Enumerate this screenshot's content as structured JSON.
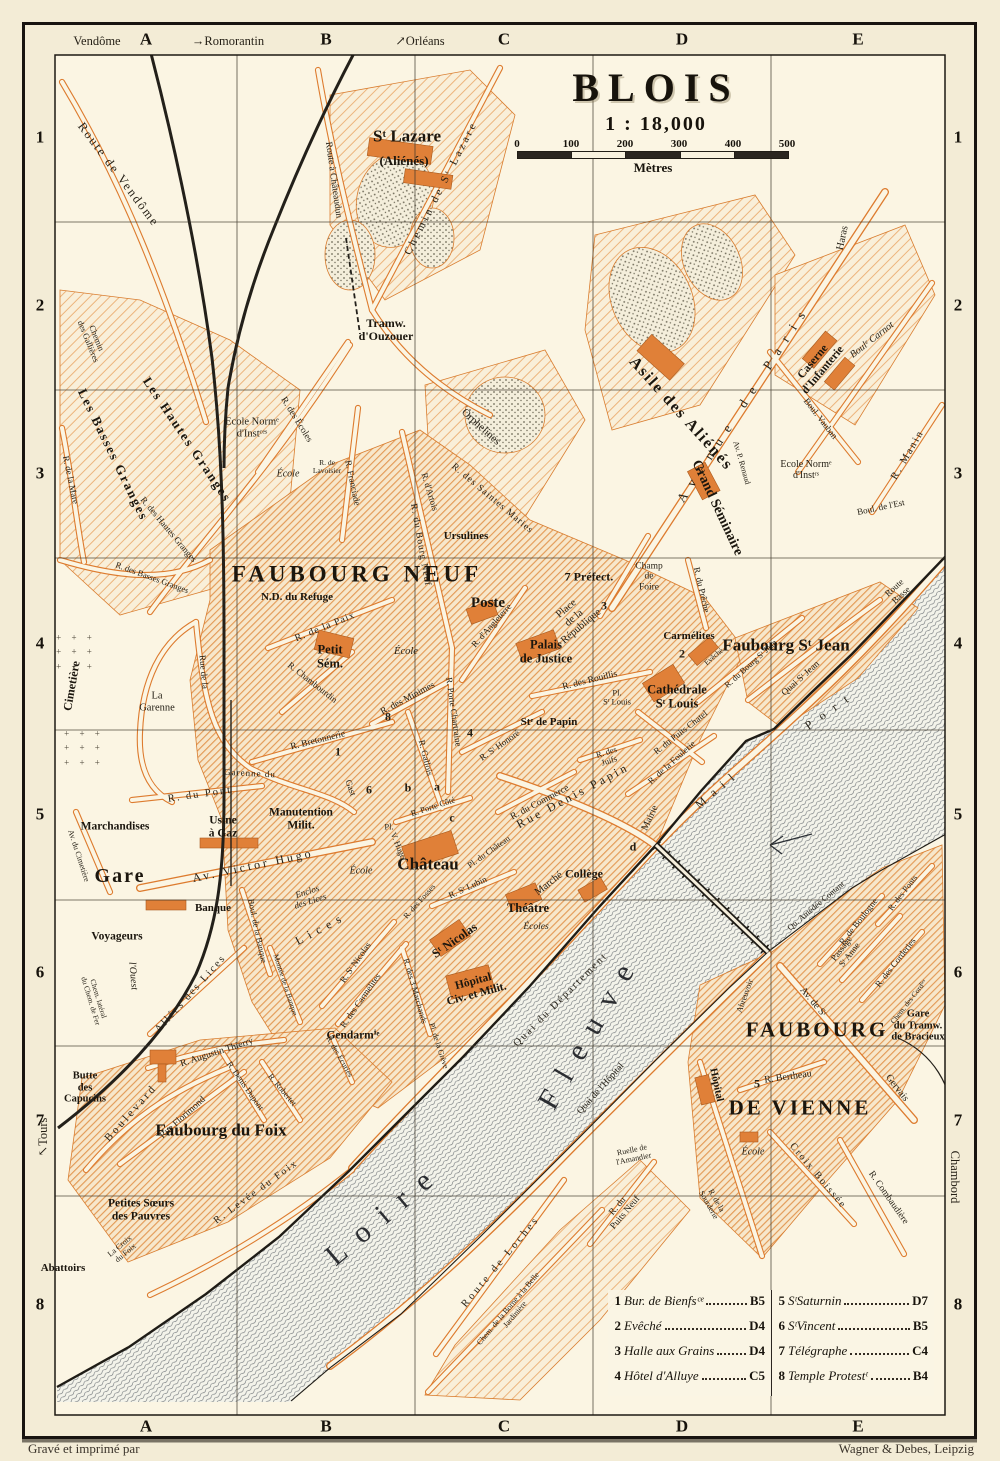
{
  "title": {
    "name": "BLOIS",
    "scale": "1 : 18,000",
    "unit": "Mètres",
    "ticks": [
      "0",
      "100",
      "200",
      "300",
      "400",
      "500"
    ]
  },
  "credits": {
    "left": "Gravé et imprimé par",
    "right": "Wagner & Debes, Leipzig"
  },
  "grid": {
    "cols": [
      "A",
      "B",
      "C",
      "D",
      "E"
    ],
    "col_x": [
      146,
      326,
      504,
      682,
      858
    ],
    "rows": [
      "1",
      "2",
      "3",
      "4",
      "5",
      "6",
      "7",
      "8"
    ],
    "row_y": [
      138,
      306,
      474,
      644,
      815,
      973,
      1121,
      1305
    ]
  },
  "legend": {
    "entries": [
      {
        "num": "1",
        "name": "Bur. de Bienfsᶜᵉ",
        "ref": "B5"
      },
      {
        "num": "2",
        "name": "Evêché",
        "ref": "D4"
      },
      {
        "num": "3",
        "name": "Halle aux Grains",
        "ref": "D4"
      },
      {
        "num": "4",
        "name": "Hôtel d'Alluye",
        "ref": "C5"
      },
      {
        "num": "5",
        "name": "SᵗSaturnin",
        "ref": "D7"
      },
      {
        "num": "6",
        "name": "SᵗVincent",
        "ref": "B5"
      },
      {
        "num": "7",
        "name": "Télégraphe",
        "ref": "C4"
      },
      {
        "num": "8",
        "name": "Temple Protestᵗ",
        "ref": "B4"
      }
    ]
  },
  "colors": {
    "paper": "#f3ecd6",
    "map_bg": "#fbf5e3",
    "street_orange": "#dd7b2e",
    "ink": "#221e16",
    "river": "#5b6167"
  },
  "map_labels": [
    {
      "t": "Vendôme",
      "x": 97,
      "y": 42,
      "c": "E"
    },
    {
      "t": "→Romorantin",
      "x": 228,
      "y": 42,
      "c": "E"
    },
    {
      "t": "↗Orléans",
      "x": 420,
      "y": 42,
      "c": "E"
    },
    {
      "t": "↖Tours",
      "x": 44,
      "y": 1137,
      "r": -90,
      "c": "E"
    },
    {
      "t": "Chambord",
      "x": 954,
      "y": 1177,
      "r": 90,
      "c": "E"
    },
    {
      "t": "Route de Vendôme",
      "x": 118,
      "y": 175,
      "r": 53,
      "s": 12.5,
      "ls": 2
    },
    {
      "t": "Chemin\ndes Gallières",
      "x": 92,
      "y": 340,
      "r": 68,
      "s": 8.5
    },
    {
      "t": "Les Hautes Granges",
      "x": 187,
      "y": 440,
      "r": 56,
      "s": 13,
      "ls": 2,
      "c": "M"
    },
    {
      "t": "Les Basses Granges",
      "x": 113,
      "y": 455,
      "r": 64,
      "s": 13,
      "ls": 2,
      "c": "M"
    },
    {
      "t": "R. des Hautes Granges",
      "x": 168,
      "y": 530,
      "r": 50,
      "s": 9
    },
    {
      "t": "R. des Basses Granges",
      "x": 152,
      "y": 578,
      "r": 20,
      "s": 8.5
    },
    {
      "t": "R. de la Mare",
      "x": 70,
      "y": 480,
      "r": 78,
      "s": 9
    },
    {
      "t": "Ecole Normᵉ\nd'Instᶜᵉˢ",
      "x": 252,
      "y": 428,
      "s": 10.5
    },
    {
      "t": "École",
      "x": 288,
      "y": 474,
      "s": 10,
      "c": "I"
    },
    {
      "t": "R. des Écoles",
      "x": 296,
      "y": 420,
      "r": 58,
      "s": 9.5
    },
    {
      "t": "R. Franciade",
      "x": 352,
      "y": 483,
      "r": 78,
      "s": 9
    },
    {
      "t": "R. de\nLavoisier",
      "x": 327,
      "y": 467,
      "s": 7.5
    },
    {
      "t": "Sᵗ Lazare",
      "x": 407,
      "y": 137,
      "s": 17,
      "c": "M"
    },
    {
      "t": "(Aliénés)",
      "x": 404,
      "y": 161,
      "s": 13,
      "c": "M"
    },
    {
      "t": "Route à Châteaudun",
      "x": 333,
      "y": 180,
      "r": 82,
      "s": 9.5
    },
    {
      "t": "Chemin de Sᵗ Lazare",
      "x": 441,
      "y": 188,
      "r": -63,
      "s": 11,
      "ls": 3
    },
    {
      "t": "Tramw.\nd'Ouzouer",
      "x": 386,
      "y": 330,
      "s": 12,
      "c": "M"
    },
    {
      "t": "Orphelines",
      "x": 481,
      "y": 427,
      "r": 42,
      "s": 11
    },
    {
      "t": "R. des Saintes Maries",
      "x": 492,
      "y": 499,
      "r": 40,
      "s": 9.5,
      "ls": 1
    },
    {
      "t": "R. d'Artois",
      "x": 429,
      "y": 492,
      "r": 73,
      "s": 9
    },
    {
      "t": "Ursulines",
      "x": 466,
      "y": 536,
      "s": 11,
      "c": "M"
    },
    {
      "t": "R. du Bourg Neuf",
      "x": 420,
      "y": 545,
      "r": 80,
      "s": 9.5,
      "ls": 1
    },
    {
      "t": "Asile des Aliénés",
      "x": 681,
      "y": 414,
      "r": 48,
      "s": 16,
      "ls": 2,
      "c": "M"
    },
    {
      "t": "Avenue de Paris",
      "x": 744,
      "y": 403,
      "r": -57,
      "s": 13,
      "ls": 10
    },
    {
      "t": "Haras",
      "x": 843,
      "y": 238,
      "r": -78,
      "s": 10.5
    },
    {
      "t": "Boulᵉ Carnot",
      "x": 872,
      "y": 340,
      "r": -38,
      "s": 10,
      "c": "I"
    },
    {
      "t": "Caserne\nd'Infanterie",
      "x": 818,
      "y": 366,
      "r": -50,
      "s": 11.5,
      "c": "M"
    },
    {
      "t": "Boul. Vauban",
      "x": 820,
      "y": 419,
      "r": 52,
      "s": 9
    },
    {
      "t": "R. Manin",
      "x": 908,
      "y": 455,
      "r": -60,
      "s": 10.5,
      "ls": 2
    },
    {
      "t": "Ecole Normᵉ\nd'Instʳˢ",
      "x": 806,
      "y": 470,
      "s": 10
    },
    {
      "t": "Av. P. Renaud",
      "x": 741,
      "y": 463,
      "r": 74,
      "s": 8
    },
    {
      "t": "Grand Séminaire",
      "x": 717,
      "y": 508,
      "r": 65,
      "s": 14,
      "c": "M"
    },
    {
      "t": "R. du Prêche",
      "x": 701,
      "y": 590,
      "r": 77,
      "s": 9
    },
    {
      "t": "Boul. de l'Est",
      "x": 881,
      "y": 508,
      "r": -12,
      "s": 9
    },
    {
      "t": "Route\nBasse",
      "x": 898,
      "y": 592,
      "r": -42,
      "s": 9
    },
    {
      "t": "Champ\nde\nFoire",
      "x": 649,
      "y": 577,
      "s": 9.5
    },
    {
      "t": "FAUBOURG NEUF",
      "x": 357,
      "y": 574,
      "s": 23,
      "ls": 4,
      "c": "B"
    },
    {
      "t": "N.D. du Refuge",
      "x": 297,
      "y": 597,
      "s": 11,
      "c": "M"
    },
    {
      "t": "R. de la Paix",
      "x": 325,
      "y": 627,
      "r": -22,
      "s": 10,
      "ls": 1
    },
    {
      "t": "Petit\nSém.",
      "x": 330,
      "y": 657,
      "s": 12.5,
      "c": "M"
    },
    {
      "t": "École",
      "x": 406,
      "y": 652,
      "s": 10.5,
      "c": "I"
    },
    {
      "t": "R. Chambourdin",
      "x": 312,
      "y": 683,
      "r": 38,
      "s": 9
    },
    {
      "t": "R. Bretonnerie",
      "x": 318,
      "y": 741,
      "r": -14,
      "s": 9.5
    },
    {
      "t": "R. des Minimes",
      "x": 408,
      "y": 699,
      "r": -28,
      "s": 9.5
    },
    {
      "t": "R. Gallois",
      "x": 425,
      "y": 758,
      "r": 76,
      "s": 9
    },
    {
      "t": "R. Porte Chartraine",
      "x": 453,
      "y": 712,
      "r": 82,
      "s": 9
    },
    {
      "t": "R. d'Angleterre",
      "x": 492,
      "y": 626,
      "r": -48,
      "s": 9
    },
    {
      "t": "Poste",
      "x": 488,
      "y": 603,
      "s": 15,
      "c": "M"
    },
    {
      "t": "Place\nde la\nRépublique",
      "x": 574,
      "y": 618,
      "r": -40,
      "s": 10.5
    },
    {
      "t": "7 Préfect.",
      "x": 589,
      "y": 577,
      "s": 12,
      "c": "M"
    },
    {
      "t": "3",
      "x": 604,
      "y": 606,
      "c": "K"
    },
    {
      "t": "Palais\nde Justice",
      "x": 546,
      "y": 652,
      "s": 12.5,
      "c": "M"
    },
    {
      "t": "Carmélites",
      "x": 689,
      "y": 636,
      "s": 11,
      "c": "M"
    },
    {
      "t": "2",
      "x": 682,
      "y": 654,
      "c": "K"
    },
    {
      "t": "Evêché",
      "x": 714,
      "y": 657,
      "r": -40,
      "s": 7.5
    },
    {
      "t": "Cathédrale\nSᵗ Louis",
      "x": 677,
      "y": 697,
      "s": 12.5,
      "c": "M"
    },
    {
      "t": "Pl.\nSᵗ Louis",
      "x": 617,
      "y": 698,
      "s": 8.5
    },
    {
      "t": "R. des Rouillis",
      "x": 590,
      "y": 681,
      "r": -14,
      "s": 9.5
    },
    {
      "t": "Stᵉ de Papin",
      "x": 549,
      "y": 722,
      "s": 11,
      "c": "M"
    },
    {
      "t": "R. Sᵗ Honoré",
      "x": 500,
      "y": 746,
      "r": -35,
      "s": 9
    },
    {
      "t": "4",
      "x": 470,
      "y": 733,
      "c": "K"
    },
    {
      "t": "8",
      "x": 388,
      "y": 717,
      "c": "K"
    },
    {
      "t": "1",
      "x": 338,
      "y": 752,
      "c": "K"
    },
    {
      "t": "6",
      "x": 369,
      "y": 790,
      "c": "K"
    },
    {
      "t": "b",
      "x": 408,
      "y": 788,
      "c": "K"
    },
    {
      "t": "a",
      "x": 437,
      "y": 787,
      "c": "K"
    },
    {
      "t": "c",
      "x": 452,
      "y": 818,
      "c": "K"
    },
    {
      "t": "d",
      "x": 633,
      "y": 847,
      "c": "K"
    },
    {
      "t": "5",
      "x": 757,
      "y": 1084,
      "c": "K"
    },
    {
      "t": "R. des\nJuifs",
      "x": 608,
      "y": 757,
      "r": -18,
      "s": 8.5
    },
    {
      "t": "Rue Denis Papin",
      "x": 573,
      "y": 796,
      "r": -28,
      "s": 12,
      "ls": 3
    },
    {
      "t": "R. du Commerce",
      "x": 540,
      "y": 803,
      "r": -28,
      "s": 9.5
    },
    {
      "t": "Faubourg Sᵗ Jean",
      "x": 786,
      "y": 646,
      "s": 17,
      "c": "M"
    },
    {
      "t": "R. du Bourg Sᵗ Jean",
      "x": 751,
      "y": 664,
      "r": -42,
      "s": 8.5
    },
    {
      "t": "Quai Sᵗ Jean",
      "x": 801,
      "y": 679,
      "r": -42,
      "s": 9.5
    },
    {
      "t": "R. du Puits Chatel",
      "x": 681,
      "y": 733,
      "r": -38,
      "s": 9
    },
    {
      "t": "R. de la Foulerie",
      "x": 672,
      "y": 763,
      "r": -42,
      "s": 9
    },
    {
      "t": "Mail",
      "x": 718,
      "y": 789,
      "r": -40,
      "s": 12,
      "ls": 8
    },
    {
      "t": "Port",
      "x": 831,
      "y": 710,
      "r": -35,
      "s": 12,
      "ls": 10
    },
    {
      "t": "Mairie",
      "x": 650,
      "y": 818,
      "r": -65,
      "s": 10
    },
    {
      "t": "Cimetière",
      "x": 72,
      "y": 686,
      "r": -80,
      "s": 12,
      "c": "M"
    },
    {
      "t": "+ + +\n+ + +\n+ + +",
      "x": 76,
      "y": 652,
      "c": "X"
    },
    {
      "t": "+ + +\n+ + +\n+ + +",
      "x": 84,
      "y": 748,
      "c": "X"
    },
    {
      "t": "La\nGarenne",
      "x": 157,
      "y": 702,
      "s": 10.5
    },
    {
      "t": "Rue de la",
      "x": 203,
      "y": 672,
      "r": 85,
      "s": 9
    },
    {
      "t": "Garenne du",
      "x": 250,
      "y": 774,
      "r": 3,
      "s": 9,
      "ls": 1
    },
    {
      "t": "Gast",
      "x": 350,
      "y": 788,
      "r": 70,
      "s": 9
    },
    {
      "t": "R. du Pont",
      "x": 200,
      "y": 795,
      "r": -8,
      "s": 10.5,
      "ls": 2
    },
    {
      "t": "Marchandises",
      "x": 115,
      "y": 827,
      "s": 11.5,
      "c": "M"
    },
    {
      "t": "Usine\nà Gaz",
      "x": 223,
      "y": 827,
      "s": 11.5,
      "c": "M"
    },
    {
      "t": "Manutention\nMilit.",
      "x": 301,
      "y": 819,
      "s": 11.5,
      "c": "M"
    },
    {
      "t": "Gare",
      "x": 120,
      "y": 876,
      "s": 20,
      "ls": 2,
      "c": "M"
    },
    {
      "t": "Av. Victor Hugo",
      "x": 253,
      "y": 866,
      "r": -12,
      "s": 12,
      "ls": 3
    },
    {
      "t": "Banque",
      "x": 213,
      "y": 908,
      "s": 11,
      "c": "M"
    },
    {
      "t": "Enclos\ndes Lices",
      "x": 309,
      "y": 897,
      "r": -18,
      "s": 9,
      "c": "I"
    },
    {
      "t": "Voyageurs",
      "x": 117,
      "y": 937,
      "s": 11.5,
      "c": "M"
    },
    {
      "t": "l'Ouest",
      "x": 133,
      "y": 976,
      "r": 85,
      "s": 10,
      "c": "I"
    },
    {
      "t": "Chem. latéral\ndu Chem. de Fer",
      "x": 94,
      "y": 1000,
      "r": 73,
      "s": 7.5
    },
    {
      "t": "Av. du Cimetière",
      "x": 78,
      "y": 856,
      "r": 72,
      "s": 8
    },
    {
      "t": "Allées des Lices",
      "x": 191,
      "y": 994,
      "r": -48,
      "s": 10.5,
      "ls": 2
    },
    {
      "t": "Lices",
      "x": 321,
      "y": 929,
      "r": -28,
      "s": 12,
      "ls": 6
    },
    {
      "t": "Boul. de la Banque",
      "x": 257,
      "y": 931,
      "r": 78,
      "s": 8.5
    },
    {
      "t": "Montée de la Banque",
      "x": 285,
      "y": 985,
      "r": 72,
      "s": 7.5
    },
    {
      "t": "R. Sᵗ Nicolas",
      "x": 356,
      "y": 963,
      "r": -55,
      "s": 9
    },
    {
      "t": "R. des Carmélites",
      "x": 361,
      "y": 1001,
      "r": -55,
      "s": 9
    },
    {
      "t": "Gendarmⁱᵉ",
      "x": 353,
      "y": 1036,
      "s": 11.5,
      "c": "M"
    },
    {
      "t": "Pl.",
      "x": 389,
      "y": 827,
      "s": 8.5
    },
    {
      "t": "V. Hugo",
      "x": 398,
      "y": 846,
      "r": 68,
      "s": 8.5
    },
    {
      "t": "École",
      "x": 361,
      "y": 871,
      "s": 10,
      "c": "I"
    },
    {
      "t": "R. Porte Côté",
      "x": 433,
      "y": 807,
      "r": -18,
      "s": 8.5
    },
    {
      "t": "Château",
      "x": 428,
      "y": 865,
      "s": 17,
      "c": "M"
    },
    {
      "t": "Pl. du Château",
      "x": 489,
      "y": 852,
      "r": -35,
      "s": 8.5
    },
    {
      "t": "R. Sᵗ Lubin",
      "x": 468,
      "y": 888,
      "r": -25,
      "s": 9
    },
    {
      "t": "Marché",
      "x": 549,
      "y": 884,
      "r": -38,
      "s": 10.5
    },
    {
      "t": "Collège",
      "x": 584,
      "y": 874,
      "s": 12,
      "c": "M"
    },
    {
      "t": "Théâtre",
      "x": 528,
      "y": 909,
      "s": 12.5,
      "c": "M"
    },
    {
      "t": "Écoles",
      "x": 536,
      "y": 927,
      "s": 9.5,
      "c": "I"
    },
    {
      "t": "Sᵗ Nicolas",
      "x": 455,
      "y": 941,
      "r": -35,
      "s": 12.5,
      "c": "M"
    },
    {
      "t": "R. des Fosses",
      "x": 420,
      "y": 902,
      "r": -48,
      "s": 8
    },
    {
      "t": "Hôpital\nCiv. et Milit.",
      "x": 475,
      "y": 988,
      "r": -15,
      "s": 11.5,
      "c": "M"
    },
    {
      "t": "Quai du Département",
      "x": 561,
      "y": 1000,
      "r": -45,
      "s": 10.5,
      "ls": 2
    },
    {
      "t": "R. des 3 Marchands",
      "x": 415,
      "y": 991,
      "r": 74,
      "s": 8.5
    },
    {
      "t": "Pl. de la Grève",
      "x": 438,
      "y": 1046,
      "r": 72,
      "s": 8
    },
    {
      "t": "R. Augustin Thierry",
      "x": 217,
      "y": 1053,
      "r": -18,
      "s": 9.5
    },
    {
      "t": "R. Denis Dupont",
      "x": 245,
      "y": 1086,
      "r": 55,
      "s": 8.5
    },
    {
      "t": "R. Robertet",
      "x": 282,
      "y": 1090,
      "r": 50,
      "s": 8.5
    },
    {
      "t": "R. des Écuries",
      "x": 339,
      "y": 1057,
      "r": 60,
      "s": 8
    },
    {
      "t": "Butte\ndes\nCapucins",
      "x": 85,
      "y": 1088,
      "s": 10.5,
      "c": "M"
    },
    {
      "t": "Boulevard",
      "x": 131,
      "y": 1113,
      "r": -48,
      "s": 11,
      "ls": 3
    },
    {
      "t": "Rue Florimond",
      "x": 183,
      "y": 1118,
      "r": -42,
      "s": 9.5
    },
    {
      "t": "Faubourg du Foix",
      "x": 221,
      "y": 1131,
      "s": 17,
      "c": "M"
    },
    {
      "t": "Petites Sœurs\ndes Pauvres",
      "x": 141,
      "y": 1210,
      "s": 11.5,
      "c": "M"
    },
    {
      "t": "R. Levée du Foix",
      "x": 256,
      "y": 1192,
      "r": -36,
      "s": 10,
      "ls": 2
    },
    {
      "t": "La Croix\ndu Foix",
      "x": 123,
      "y": 1250,
      "r": -40,
      "s": 8
    },
    {
      "t": "Abattoirs",
      "x": 63,
      "y": 1268,
      "s": 11,
      "c": "M"
    },
    {
      "t": "Loire",
      "x": 385,
      "y": 1213,
      "r": -40,
      "s": 30,
      "ls": 16,
      "c": "W"
    },
    {
      "t": "Fleuve",
      "x": 590,
      "y": 1030,
      "r": -60,
      "s": 30,
      "ls": 16,
      "c": "W"
    },
    {
      "t": "Qu. Amédée Contant",
      "x": 816,
      "y": 906,
      "r": -40,
      "s": 8.5
    },
    {
      "t": "Abreuvoir",
      "x": 745,
      "y": 996,
      "r": -70,
      "s": 8.5
    },
    {
      "t": "Quai de l'Hôpital",
      "x": 601,
      "y": 1089,
      "r": -48,
      "s": 9.5
    },
    {
      "t": "R. de Boulogne",
      "x": 859,
      "y": 922,
      "r": -52,
      "s": 9
    },
    {
      "t": "Passage\nSᵗ Anne",
      "x": 846,
      "y": 952,
      "r": -52,
      "s": 9
    },
    {
      "t": "R. des Corderies",
      "x": 896,
      "y": 963,
      "r": -52,
      "s": 9
    },
    {
      "t": "Chem. des Cordⁱᵉˢ",
      "x": 909,
      "y": 1002,
      "r": -52,
      "s": 7.5
    },
    {
      "t": "R. des Ponts",
      "x": 903,
      "y": 893,
      "r": -52,
      "s": 8.5
    },
    {
      "t": "Gare\ndu Tramw.\nde Bracieux",
      "x": 918,
      "y": 1026,
      "s": 10.5,
      "c": "M"
    },
    {
      "t": "Av. de Sᵗ",
      "x": 813,
      "y": 1002,
      "r": 50,
      "s": 10
    },
    {
      "t": "Gervais",
      "x": 897,
      "y": 1088,
      "r": 52,
      "s": 10
    },
    {
      "t": "FAUBOURG",
      "x": 817,
      "y": 1030,
      "s": 21,
      "ls": 3,
      "c": "B"
    },
    {
      "t": "DE VIENNE",
      "x": 800,
      "y": 1108,
      "s": 21,
      "ls": 3,
      "c": "B"
    },
    {
      "t": "R. Bertheau",
      "x": 788,
      "y": 1077,
      "r": -8,
      "s": 10
    },
    {
      "t": "Hôpital",
      "x": 716,
      "y": 1085,
      "r": 78,
      "s": 10.5,
      "c": "M"
    },
    {
      "t": "École",
      "x": 753,
      "y": 1152,
      "s": 10,
      "c": "I"
    },
    {
      "t": "Croix Boissée",
      "x": 818,
      "y": 1176,
      "r": 50,
      "s": 10,
      "ls": 2
    },
    {
      "t": "R. Combaudière",
      "x": 888,
      "y": 1198,
      "r": 55,
      "s": 9.5
    },
    {
      "t": "R. de la\nSourderie",
      "x": 712,
      "y": 1203,
      "r": 60,
      "s": 8
    },
    {
      "t": "Ruelle de\nl'Amandier",
      "x": 633,
      "y": 1155,
      "r": -12,
      "s": 8
    },
    {
      "t": "R. du\nPuits Neuf",
      "x": 622,
      "y": 1210,
      "r": -50,
      "s": 9.5
    },
    {
      "t": "Route de Loches",
      "x": 501,
      "y": 1262,
      "r": -50,
      "s": 10.5,
      "ls": 3
    },
    {
      "t": "Chem. de la Borne à la Belle\nJardinière",
      "x": 512,
      "y": 1312,
      "r": -50,
      "s": 8
    }
  ]
}
